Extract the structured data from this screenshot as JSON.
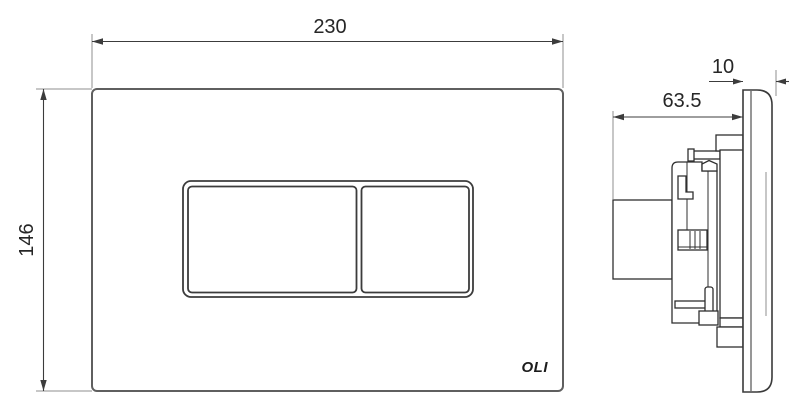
{
  "front_view": {
    "width_dimension": "230",
    "height_dimension": "146",
    "logo": "OLI"
  },
  "side_view": {
    "depth_dimension": "63.5",
    "plate_thickness_dimension": "10"
  },
  "colors": {
    "plate_outline": "#5f5f5f",
    "button_outline": "#3c3c3c",
    "side_detail": "#2f2f2f",
    "dimension_line": "#3c3c3c",
    "extension_line": "#8f8f8f",
    "dimension_text": "#262626",
    "logo_text": "#1c1c1c",
    "background": "#ffffff"
  }
}
